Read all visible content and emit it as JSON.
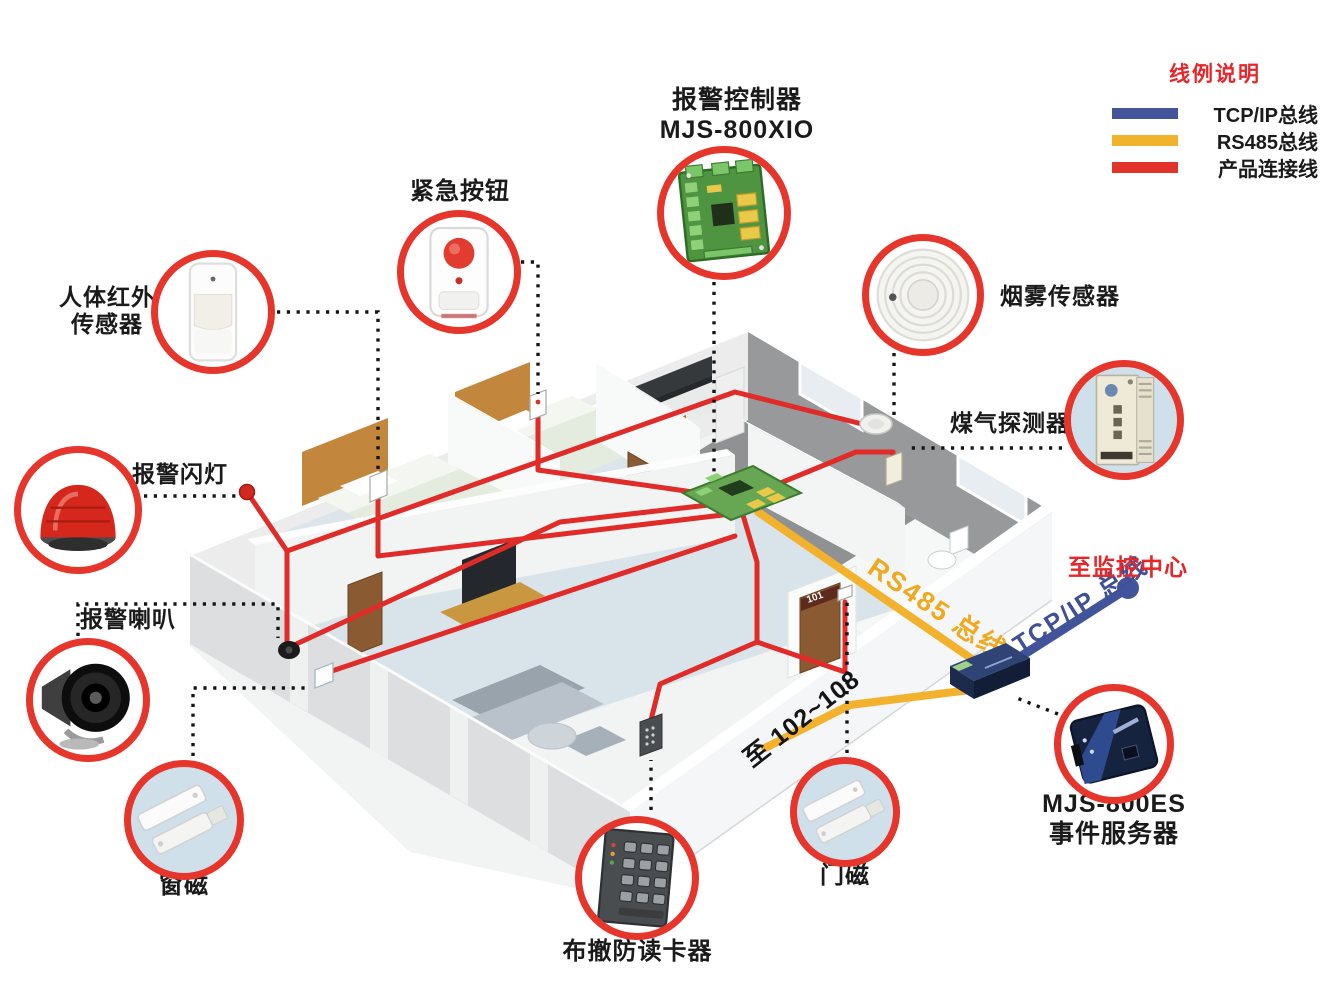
{
  "legend": {
    "title": "线例说明",
    "items": [
      {
        "label": "TCP/IP总线",
        "color": "#44549b"
      },
      {
        "label": "RS485总线",
        "color": "#f0b32b"
      },
      {
        "label": "产品连接线",
        "color": "#e2332b"
      }
    ]
  },
  "labels": {
    "controller_1": "报警控制器",
    "controller_2": "MJS-800XIO",
    "emergency": "紧急按钮",
    "pir_1": "人体红外",
    "pir_2": "传感器",
    "strobe": "报警闪灯",
    "siren": "报警喇叭",
    "window_magnet": "窗磁",
    "card_reader": "布撤防读卡器",
    "door_magnet": "门磁",
    "smoke": "烟雾传感器",
    "gas": "煤气探测器",
    "server_1": "MJS-800ES",
    "server_2": "事件服务器"
  },
  "annotations": {
    "rs485": "RS485 总线",
    "tcpip": "TCP/IP 总线",
    "to_rooms": "至 102~108",
    "to_center": "至监控中心",
    "door_sign": "101"
  },
  "colors": {
    "line_red": "#e02b28",
    "line_yellow": "#f2b22e",
    "line_blue": "#41549b",
    "callout_ring": "#e6352b"
  }
}
